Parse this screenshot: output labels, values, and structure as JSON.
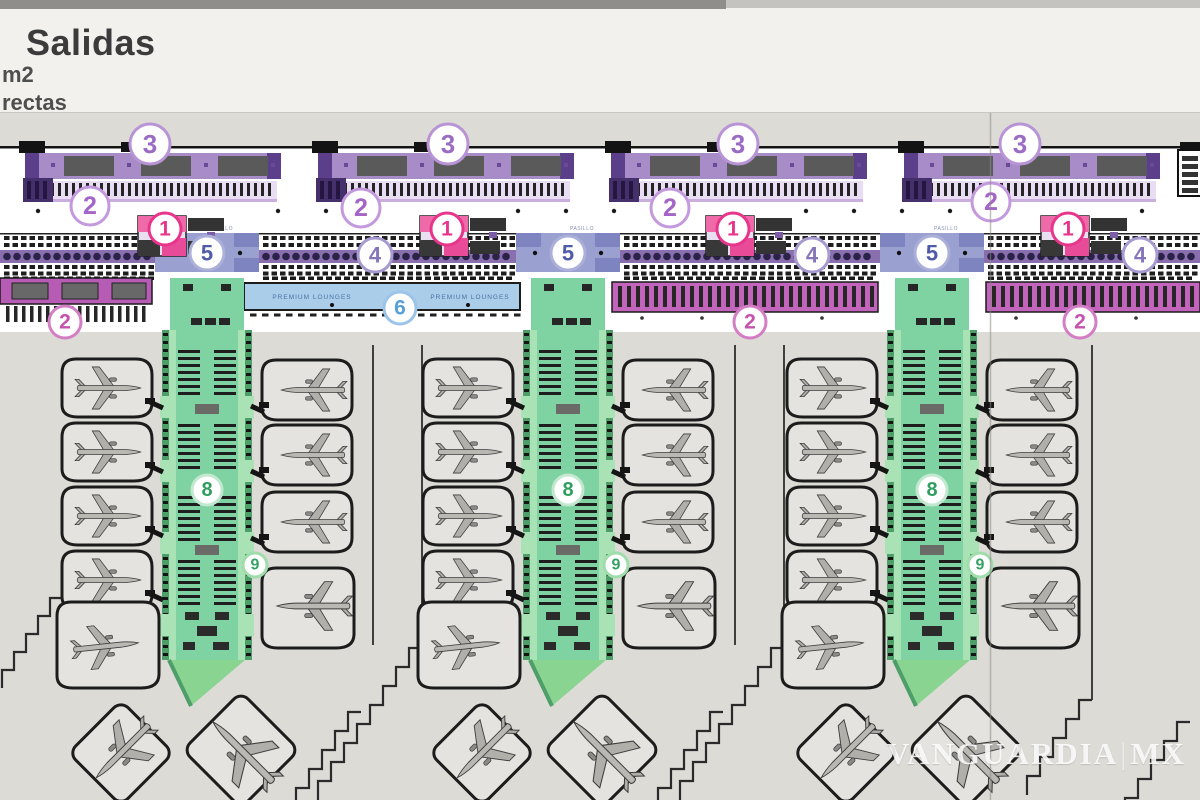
{
  "header": {
    "title": "Salidas",
    "line2": "m2",
    "line3": "rectas"
  },
  "watermark": {
    "part1": "VANGUARDIA",
    "sep": "|",
    "part2": "MX"
  },
  "plan_labels": {
    "premium_lounges": {
      "text": "PREMIUM LOUNGES",
      "positions": [
        [
          312,
          299
        ],
        [
          470,
          299
        ]
      ]
    },
    "corridor": {
      "text": "PASILLO",
      "y": 230
    }
  },
  "colors": {
    "apron": "#dcdbd6",
    "concourse": "#ffffff",
    "facade": "#131313",
    "checkin_band": "#a78cc8",
    "checkin_light": "#c3a8da",
    "checkin_cap": "#5c3f8a",
    "counter_gray": "#5a5a5a",
    "teeth_bg": "#e8ddf2",
    "teeth": "#252525",
    "checkin_block": "#46306b",
    "checkin_underline": "#c9aede",
    "seat_black": "#1e1e1e",
    "seat_band": "#8a6fae",
    "seat_dot": "#2a2248",
    "corridor": "#9aa0d0",
    "corridor_block": "#7d84bf",
    "corridor_label": "#8a8fb8",
    "lounge": "#aacdea",
    "lounge_text": "#49759f",
    "magenta": "#c263bc",
    "magenta_left": "#b75cb4",
    "kiosk_pink": "#ef6aa8",
    "kiosk_pink2": "#e84b98",
    "kiosk_dark": "#333333",
    "pier": "#7fd2a2",
    "pier_light": "#a9e2b4",
    "pier_edge": "#4e9e6a",
    "pier_tip": "#8ad492",
    "stand_fill": "#e4e3df",
    "stand_stroke": "#1c1c1c",
    "plane_fill": "#b9b8b3",
    "plane_stroke": "#3e3e3e",
    "steps": "#2a2a2a",
    "fold": "#8c8a84",
    "lane": "#2e2e2e",
    "dot": "#1b1b1b"
  },
  "plan": {
    "modules_x": [
      25,
      318,
      611,
      904
    ],
    "band_width": 256,
    "piers_x": [
      207,
      568,
      932
    ],
    "kiosks_x": [
      165,
      447,
      733,
      1068
    ],
    "area4_spans": [
      [
        0,
        155
      ],
      [
        259,
        516
      ],
      [
        620,
        880
      ],
      [
        984,
        1200
      ]
    ],
    "gap_lines_x": [
      373,
      422,
      735,
      784,
      1092
    ],
    "lounge_span": [
      244,
      520
    ],
    "magenta_spans": [
      [
        612,
        878
      ],
      [
        986,
        1200
      ]
    ],
    "left_band_span": [
      0,
      152
    ]
  },
  "zones": [
    {
      "n": "3",
      "cx": 150,
      "cy": 144,
      "r": 20,
      "ring": "#b894d6",
      "color": "#9a6cc4"
    },
    {
      "n": "3",
      "cx": 448,
      "cy": 144,
      "r": 20,
      "ring": "#b894d6",
      "color": "#9a6cc4"
    },
    {
      "n": "3",
      "cx": 738,
      "cy": 144,
      "r": 20,
      "ring": "#b894d6",
      "color": "#9a6cc4"
    },
    {
      "n": "3",
      "cx": 1020,
      "cy": 144,
      "r": 20,
      "ring": "#b894d6",
      "color": "#9a6cc4"
    },
    {
      "n": "2",
      "cx": 90,
      "cy": 206,
      "r": 19,
      "ring": "#c49ade",
      "color": "#a565c8"
    },
    {
      "n": "2",
      "cx": 361,
      "cy": 208,
      "r": 19,
      "ring": "#c49ade",
      "color": "#a565c8"
    },
    {
      "n": "2",
      "cx": 670,
      "cy": 208,
      "r": 19,
      "ring": "#c49ade",
      "color": "#a565c8"
    },
    {
      "n": "2",
      "cx": 991,
      "cy": 202,
      "r": 19,
      "ring": "#c49ade",
      "color": "#a565c8"
    },
    {
      "n": "1",
      "cx": 165,
      "cy": 229,
      "r": 16,
      "ring": "#e8358c",
      "color": "#e8358c"
    },
    {
      "n": "1",
      "cx": 447,
      "cy": 229,
      "r": 16,
      "ring": "#e8358c",
      "color": "#e8358c"
    },
    {
      "n": "1",
      "cx": 733,
      "cy": 229,
      "r": 16,
      "ring": "#e8358c",
      "color": "#e8358c"
    },
    {
      "n": "1",
      "cx": 1068,
      "cy": 229,
      "r": 16,
      "ring": "#e8358c",
      "color": "#e8358c"
    },
    {
      "n": "5",
      "cx": 207,
      "cy": 253,
      "r": 17,
      "ring": "#aab0d8",
      "color": "#4f5aa8"
    },
    {
      "n": "5",
      "cx": 568,
      "cy": 253,
      "r": 17,
      "ring": "#aab0d8",
      "color": "#4f5aa8"
    },
    {
      "n": "5",
      "cx": 932,
      "cy": 253,
      "r": 17,
      "ring": "#aab0d8",
      "color": "#4f5aa8"
    },
    {
      "n": "4",
      "cx": 375,
      "cy": 255,
      "r": 17,
      "ring": "#a79ad0",
      "color": "#8576b8"
    },
    {
      "n": "4",
      "cx": 812,
      "cy": 255,
      "r": 17,
      "ring": "#a79ad0",
      "color": "#8576b8"
    },
    {
      "n": "4",
      "cx": 1140,
      "cy": 255,
      "r": 17,
      "ring": "#a79ad0",
      "color": "#8576b8"
    },
    {
      "n": "6",
      "cx": 400,
      "cy": 308,
      "r": 16,
      "ring": "#9cc4e8",
      "color": "#56a0d8"
    },
    {
      "n": "2",
      "cx": 65,
      "cy": 322,
      "r": 16,
      "ring": "#d37ec4",
      "color": "#c553ae"
    },
    {
      "n": "2",
      "cx": 750,
      "cy": 322,
      "r": 16,
      "ring": "#d37ec4",
      "color": "#c553ae"
    },
    {
      "n": "2",
      "cx": 1080,
      "cy": 322,
      "r": 16,
      "ring": "#d37ec4",
      "color": "#c553ae"
    },
    {
      "n": "8",
      "cx": 207,
      "cy": 490,
      "r": 15,
      "ring": "#c2e9d0",
      "color": "#2f9e5e"
    },
    {
      "n": "8",
      "cx": 568,
      "cy": 490,
      "r": 15,
      "ring": "#c2e9d0",
      "color": "#2f9e5e"
    },
    {
      "n": "8",
      "cx": 932,
      "cy": 490,
      "r": 15,
      "ring": "#c2e9d0",
      "color": "#2f9e5e"
    },
    {
      "n": "9",
      "cx": 255,
      "cy": 565,
      "r": 12,
      "ring": "#a0dcac",
      "color": "#35a263"
    },
    {
      "n": "9",
      "cx": 616,
      "cy": 565,
      "r": 12,
      "ring": "#a0dcac",
      "color": "#35a263"
    },
    {
      "n": "9",
      "cx": 980,
      "cy": 565,
      "r": 12,
      "ring": "#a0dcac",
      "color": "#35a263"
    }
  ]
}
